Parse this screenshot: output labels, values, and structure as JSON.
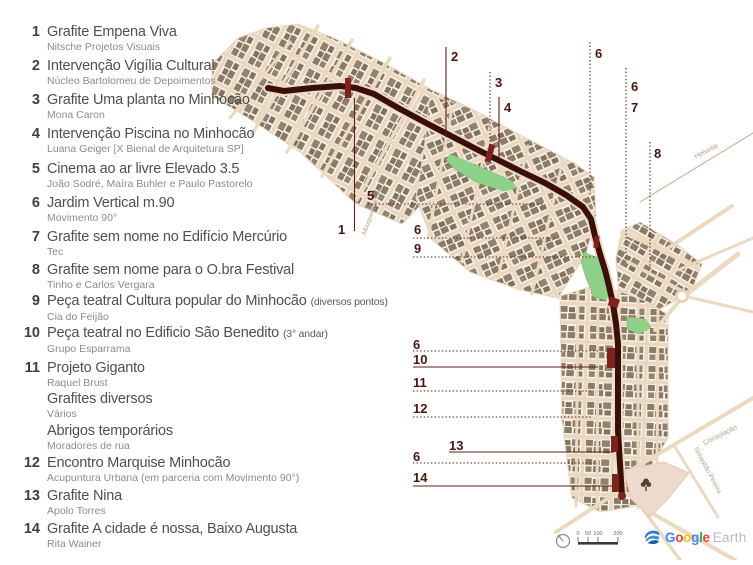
{
  "legend": {
    "items": [
      {
        "num": "1",
        "title": "Grafite Empena Viva",
        "note": "",
        "subtitle": "Nitsche Projetos Visuais"
      },
      {
        "num": "2",
        "title": "Intervenção Vigília Cultural",
        "note": "",
        "subtitle": "Núcleo Bartolomeu de Depoimentos"
      },
      {
        "num": "3",
        "title": "Grafite Uma planta no Minhocão",
        "note": "",
        "subtitle": "Mona Caron"
      },
      {
        "num": "4",
        "title": "Intervenção Piscina no Minhocão",
        "note": "",
        "subtitle": "Luana Geiger [X Bienal de Arquitetura SP]"
      },
      {
        "num": "5",
        "title": "Cinema ao ar livre Elevado 3.5",
        "note": "",
        "subtitle": "João Sodré, Maíra Buhler e Paulo Pastorelo"
      },
      {
        "num": "6",
        "title": "Jardim Vertical m.90",
        "note": "",
        "subtitle": "Movimento 90°"
      },
      {
        "num": "7",
        "title": "Grafite sem nome no Edifício Mercúrio",
        "note": "",
        "subtitle": "Tec"
      },
      {
        "num": "8",
        "title": "Grafite sem nome para o O.bra Festival",
        "note": "",
        "subtitle": "Tinho e Carlos Vergara"
      },
      {
        "num": "9",
        "title": "Peça teatral Cultura popular do Minhocão",
        "note": "(diversos pontos)",
        "subtitle": "Cia do Feijão"
      },
      {
        "num": "10",
        "title": "Peça teatral no Edificio São Benedito",
        "note": "(3° andar)",
        "subtitle": "Grupo Esparrama"
      },
      {
        "num": "11",
        "title": "Projeto Giganto",
        "note": "",
        "subtitle": "Raquel Brust"
      },
      {
        "num": "",
        "title": "Grafites diversos",
        "note": "",
        "subtitle": "Vários"
      },
      {
        "num": "",
        "title": "Abrigos temporários",
        "note": "",
        "subtitle": "Moradores de rua"
      },
      {
        "num": "12",
        "title": "Encontro Marquise Minhocão",
        "note": "",
        "subtitle": "Acupuntura Urbana (em parceria com Movimento 90°)"
      },
      {
        "num": "13",
        "title": "Grafite Nina",
        "note": "",
        "subtitle": "Apolo Torres"
      },
      {
        "num": "14",
        "title": "Grafite A cidade é nossa, Baixo Augusta",
        "note": "",
        "subtitle": "Rita Wainer"
      }
    ]
  },
  "map": {
    "callouts": [
      {
        "label": "2"
      },
      {
        "label": "3"
      },
      {
        "label": "4"
      },
      {
        "label": "6"
      },
      {
        "label": "6"
      },
      {
        "label": "7"
      },
      {
        "label": "8"
      },
      {
        "label": "1"
      },
      {
        "label": "5"
      },
      {
        "label": "6"
      },
      {
        "label": "9"
      },
      {
        "label": "6"
      },
      {
        "label": "10"
      },
      {
        "label": "11"
      },
      {
        "label": "12"
      },
      {
        "label": "13"
      },
      {
        "label": "6"
      },
      {
        "label": "14"
      }
    ],
    "street_labels": [
      {
        "id": "albuquerque",
        "text": "Albuquerque Lins"
      },
      {
        "id": "helvetia",
        "text": "Helvetia"
      },
      {
        "id": "consolacao",
        "text": "Consolação"
      },
      {
        "id": "sebastiao",
        "text": "Sebastião Pereira"
      }
    ],
    "scale_ticks": [
      "0",
      "50",
      "100",
      "200"
    ]
  },
  "footer": {
    "logo_word": "Google",
    "logo_word_colors": [
      "#4285F4",
      "#EA4335",
      "#FBBC05",
      "#4285F4",
      "#34A853",
      "#EA4335"
    ],
    "logo_suffix": "Earth"
  },
  "colors": {
    "route": "#3a0f0b",
    "marker": "#7c241c",
    "leader": "#5e1d15",
    "callout_text": "#4a150f",
    "park": "#8ed189",
    "street": "#ecd9c1",
    "building": "#8c7b66",
    "block_ground": "#f7f1e8",
    "plaza": "#eedacc",
    "street_label": "#b0a08b"
  }
}
